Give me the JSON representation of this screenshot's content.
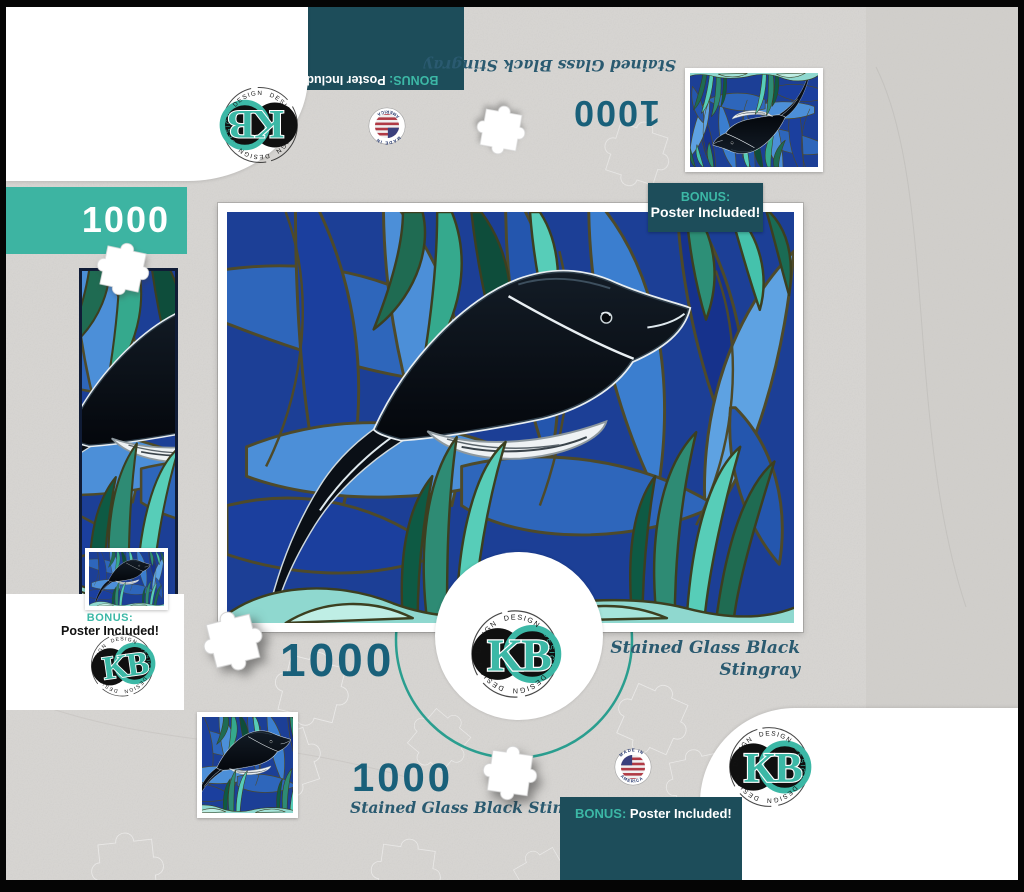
{
  "brand": {
    "initials": "KB",
    "ring_word": "DESIGN"
  },
  "puzzle": {
    "piece_count": "1000",
    "title": "Stained Glass Black Stingray",
    "title_line1": "Stained Glass Black",
    "title_line2": "Stingray",
    "bonus_label": "BONUS:",
    "bonus_value": "Poster Included!",
    "made_in_line1": "MADE IN",
    "made_in_line2": "AMERICA"
  },
  "colors": {
    "dark_teal": "#1d4d5a",
    "accent_teal": "#3cb8a6",
    "banner_teal": "#3db4a2",
    "count_teal": "#19607a",
    "script_blue": "#2a5a70",
    "paper_gray": "#d7d5d2"
  }
}
